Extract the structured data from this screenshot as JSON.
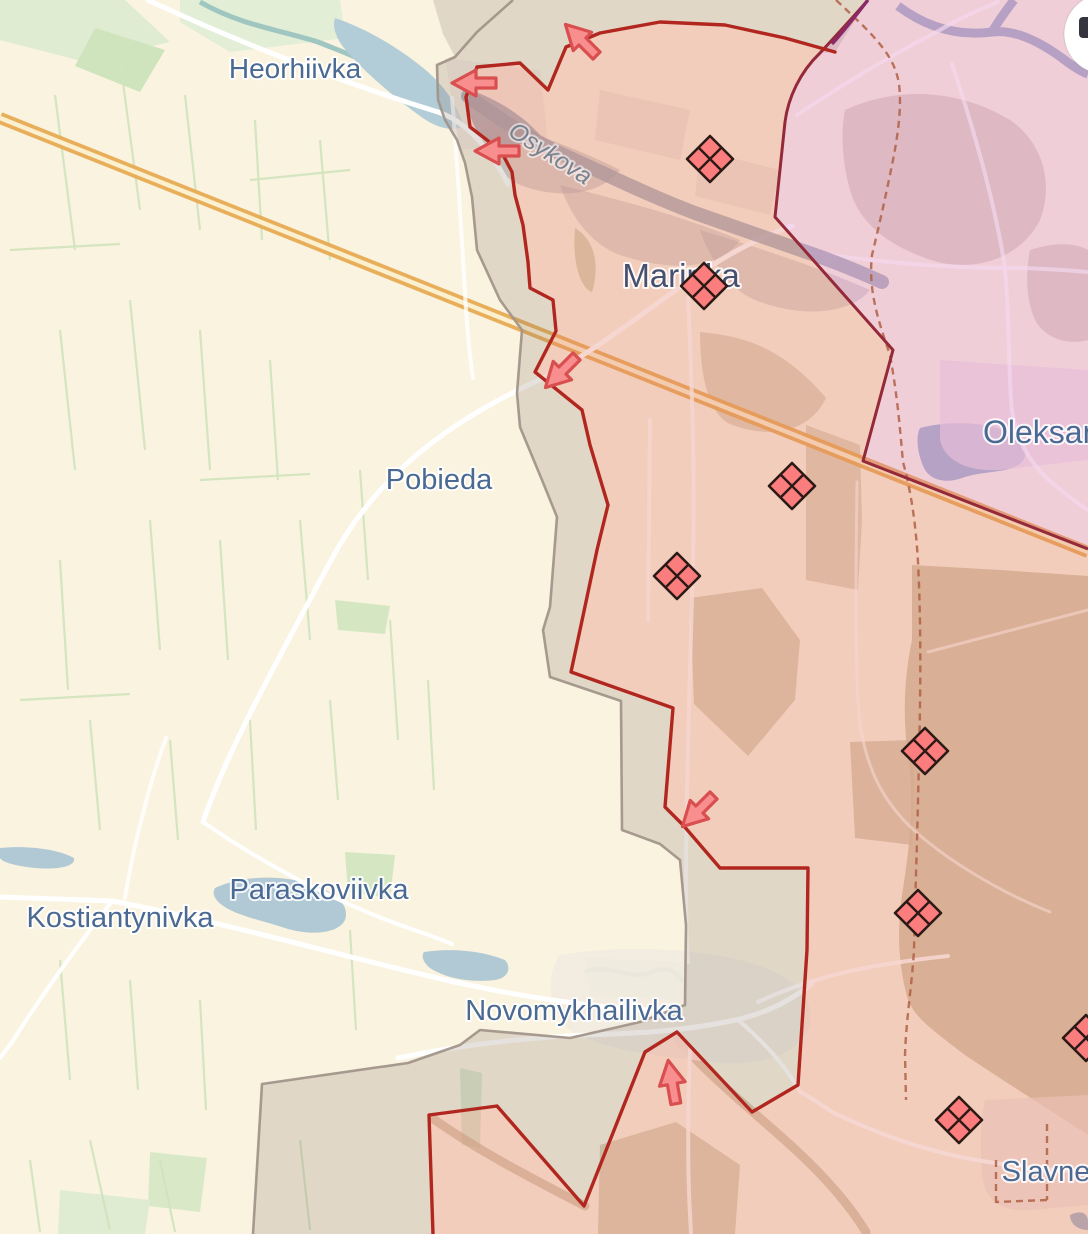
{
  "app": {
    "name": "frontline-situation-map"
  },
  "map": {
    "background": "#faf3e0",
    "colors": {
      "frontline": "#b1271f",
      "legacy_boundary": "#942939",
      "legacy_boundary_tip": "#8a2a68",
      "occupied_fill": "rgba(226,118,102,0.30)",
      "grey_zone_fill": "rgba(138,118,108,0.22)",
      "grey_zone_line": "#a2958a",
      "legacy_fill": "rgba(215,110,195,0.28)",
      "marker_fill": "#fb7d7d",
      "marker_stroke": "#2b1a15",
      "arrow_fill": "#f98e8e",
      "arrow_stroke": "#d94f4f",
      "label_color": "#4a6a94",
      "city_label_color": "#47506e",
      "water_label_color": "#78828f"
    },
    "labels": [
      {
        "id": "heorhiivka",
        "text": "Heorhiivka",
        "x": 295,
        "y": 78,
        "size": 28
      },
      {
        "id": "marinka",
        "text": "Marinka",
        "x": 681,
        "y": 287,
        "size": 33,
        "kind": "city"
      },
      {
        "id": "pobieda",
        "text": "Pobieda",
        "x": 439,
        "y": 489,
        "size": 29
      },
      {
        "id": "kostiantynivka",
        "text": "Kostiantynivka",
        "x": 120,
        "y": 927,
        "size": 29
      },
      {
        "id": "paraskoviivka",
        "text": "Paraskoviivka",
        "x": 319,
        "y": 899,
        "size": 29
      },
      {
        "id": "novomykhailivka",
        "text": "Novomykhailivka",
        "x": 574,
        "y": 1020,
        "size": 29
      },
      {
        "id": "oleksandrivka",
        "text": "Oleksandrivka",
        "x": 983,
        "y": 443,
        "size": 32,
        "anchor": "start"
      },
      {
        "id": "slavne",
        "text": "Slavne",
        "x": 1046,
        "y": 1181,
        "size": 29
      },
      {
        "id": "osykova-river",
        "text": "Osykova",
        "x": 546,
        "y": 160,
        "size": 24,
        "rotate": 33,
        "kind": "water"
      }
    ],
    "markers": {
      "meaning": "clash-diamond",
      "positions": [
        [
          710,
          159
        ],
        [
          704,
          286
        ],
        [
          792,
          486
        ],
        [
          677,
          576
        ],
        [
          925,
          751
        ],
        [
          918,
          913
        ],
        [
          959,
          1120
        ],
        [
          1086,
          1038
        ]
      ]
    },
    "arrows": {
      "meaning": "attack-direction",
      "items": [
        {
          "x": 581,
          "y": 40,
          "rotate": 45
        },
        {
          "x": 474,
          "y": 83,
          "rotate": 0
        },
        {
          "x": 497,
          "y": 151,
          "rotate": 0
        },
        {
          "x": 561,
          "y": 372,
          "rotate": -45
        },
        {
          "x": 698,
          "y": 811,
          "rotate": -45
        },
        {
          "x": 672,
          "y": 1082,
          "rotate": 80
        }
      ]
    },
    "controls": {
      "top_right_button": {
        "shape": "circle",
        "icon": "partial-glyph"
      }
    }
  }
}
